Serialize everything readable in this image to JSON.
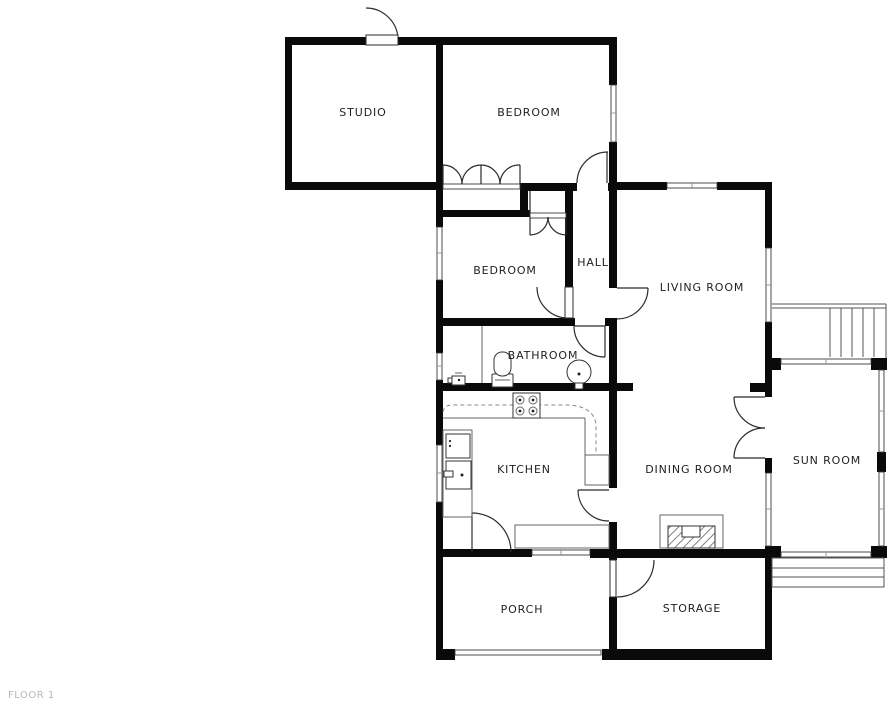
{
  "floor": {
    "label": "FLOOR 1"
  },
  "rooms": {
    "studio": {
      "label": "STUDIO"
    },
    "bedroom_top": {
      "label": "BEDROOM"
    },
    "bedroom_middle": {
      "label": "BEDROOM"
    },
    "hall": {
      "label": "HALL"
    },
    "living_room": {
      "label": "LIVING ROOM"
    },
    "bathroom": {
      "label": "BATHROOM"
    },
    "kitchen": {
      "label": "KITCHEN"
    },
    "dining_room": {
      "label": "DINING ROOM"
    },
    "sun_room": {
      "label": "SUN ROOM"
    },
    "porch": {
      "label": "PORCH"
    },
    "storage": {
      "label": "STORAGE"
    }
  },
  "fixtures": [
    "toilet",
    "round-basin-sink",
    "small-wash-basin",
    "stove-4-burner",
    "kitchen-sink",
    "kitchen-appliance",
    "fireplace",
    "staircase",
    "exterior-steps",
    "french-doors",
    "closet-bifold-doors"
  ],
  "colors": {
    "wall": "#0a0a0a",
    "label_text": "#1f1f1f",
    "floor_label_text": "#b4b7b9",
    "background": "#ffffff"
  }
}
